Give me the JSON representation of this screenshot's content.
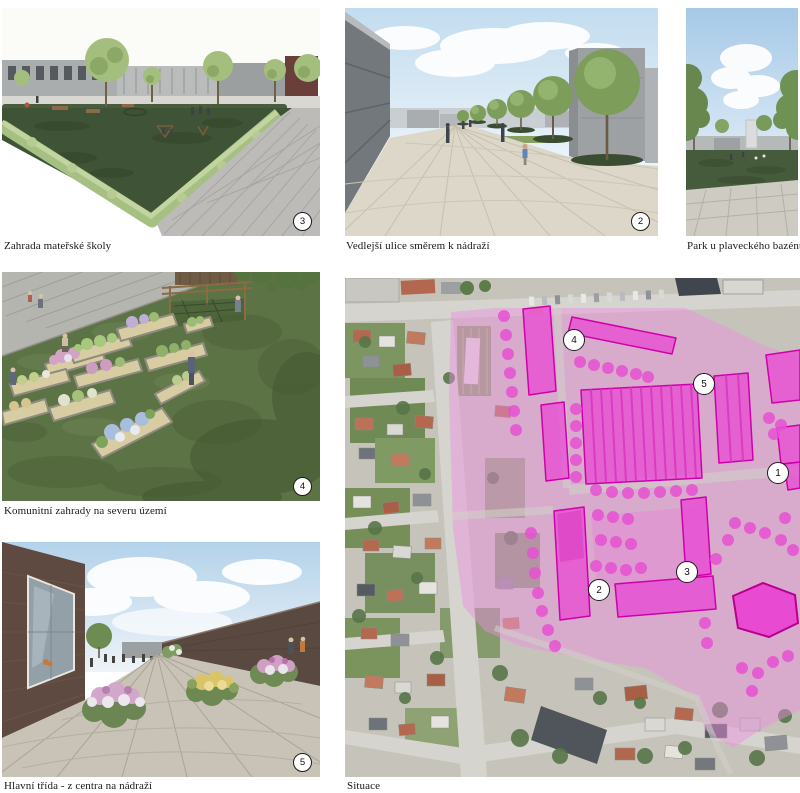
{
  "panels": [
    {
      "caption": "Zahrada mateřské školy",
      "badge": "3"
    },
    {
      "caption": "Vedlejší ulice směrem k nádraží",
      "badge": "2"
    },
    {
      "caption": "Park u plaveckého bazénu",
      "badge": ""
    },
    {
      "caption": "Komunitní zahrady na severu území",
      "badge": "4"
    },
    {
      "caption": "Hlavní třída - z centra na nádraží",
      "badge": "5"
    },
    {
      "caption": "Situace",
      "badge": ""
    }
  ],
  "map": {
    "badges": [
      {
        "label": "1",
        "x": 432,
        "y": 194
      },
      {
        "label": "2",
        "x": 253,
        "y": 311
      },
      {
        "label": "3",
        "x": 341,
        "y": 293
      },
      {
        "label": "4",
        "x": 228,
        "y": 61
      },
      {
        "label": "5",
        "x": 358,
        "y": 105
      }
    ],
    "legend_colors": {
      "overlay_wash": "#ee8fe2",
      "building_fill": "#e84fd3",
      "building_stroke": "#cf00ab",
      "tree_dot": "#e650d2"
    }
  }
}
